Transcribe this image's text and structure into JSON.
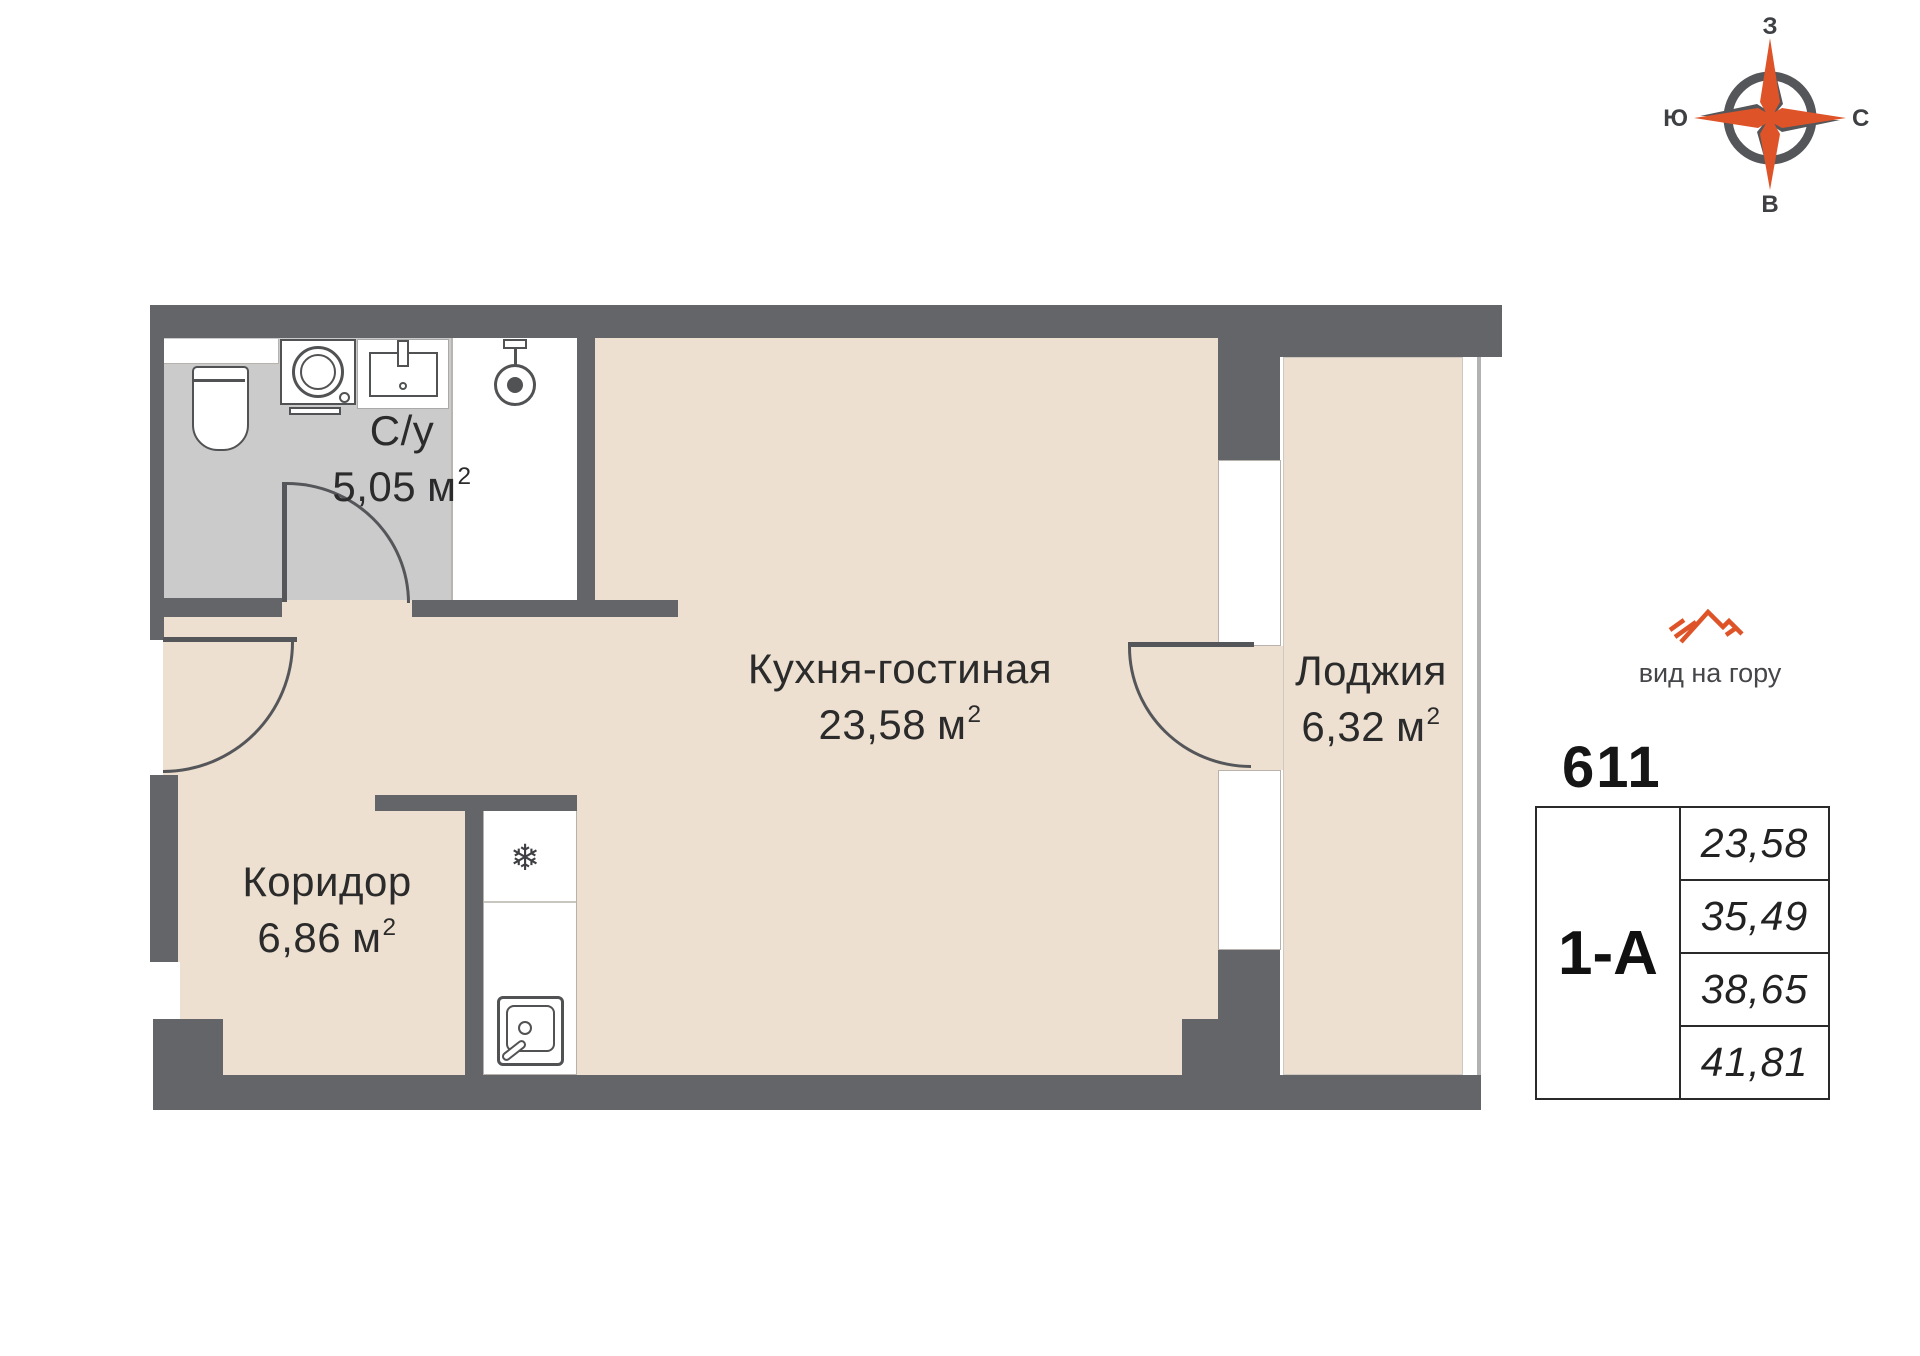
{
  "compass": {
    "top": "З",
    "right": "С",
    "bottom": "В",
    "left": "Ю"
  },
  "rooms": {
    "bathroom": {
      "name": "С/у",
      "area": "5,05"
    },
    "kitchen_living": {
      "name": "Кухня-гостиная",
      "area": "23,58"
    },
    "loggia": {
      "name": "Лоджия",
      "area": "6,32"
    },
    "corridor": {
      "name": "Коридор",
      "area": "6,86"
    }
  },
  "area_unit": {
    "base": "м",
    "sup": "2"
  },
  "icons": {
    "fridge": "❄"
  },
  "info": {
    "view_note": "вид на гору",
    "apartment_number": "611",
    "layout_type": "1-А",
    "areas": [
      "23,58",
      "35,49",
      "38,65",
      "41,81"
    ]
  },
  "colors": {
    "wall": "#646569",
    "floor": "#EDE0D0",
    "wet_floor": "#CBCBCB",
    "accent": "#DE5428",
    "door_line": "#55565A"
  }
}
